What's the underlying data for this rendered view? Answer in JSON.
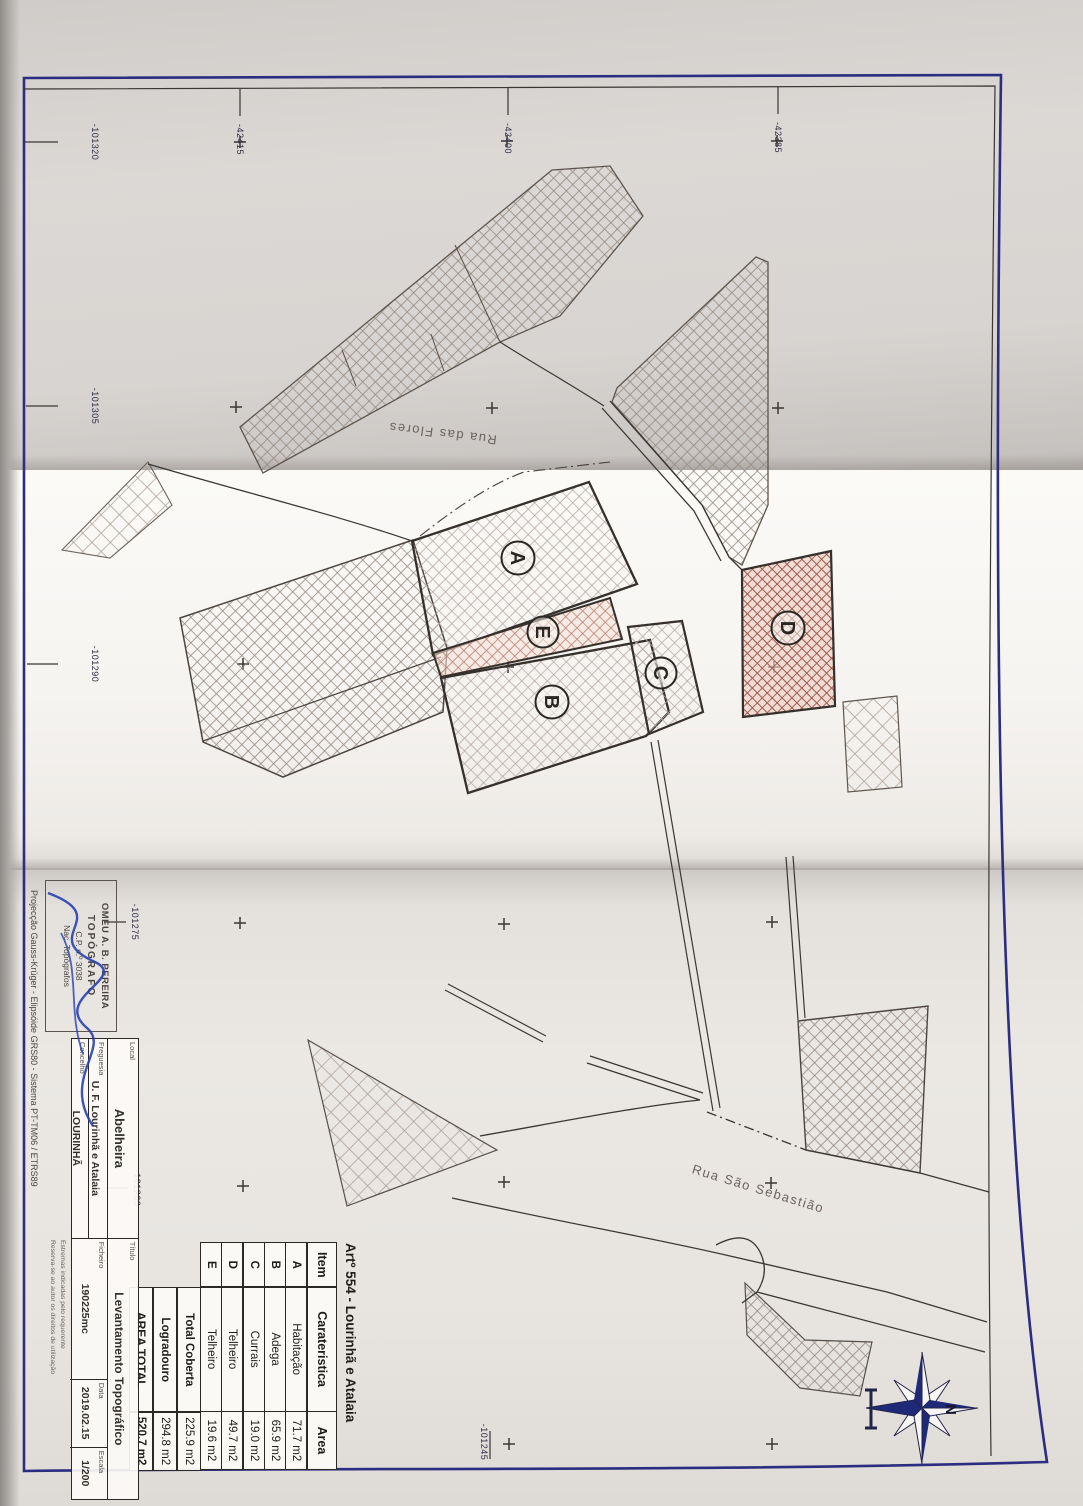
{
  "grid": {
    "top_labels": [
      "-42415",
      "-42400",
      "-42385"
    ],
    "left_labels": [
      "-101320",
      "-101305",
      "-101290",
      "-101275",
      "-101260"
    ],
    "bottom_label": "-101245"
  },
  "streets": {
    "rua_das_flores": "Rua das Flores",
    "rua_sao_sebastiao": "Rua São Sebastião"
  },
  "buildings": {
    "a": "A",
    "b": "B",
    "c": "C",
    "d": "D",
    "e": "E"
  },
  "compass": {
    "north_label": "N"
  },
  "area_table": {
    "title": "Artº 554 - Lourinhã e Atalaia",
    "headers": {
      "item": "Item",
      "caracteristica": "Carateristica",
      "area": "Area"
    },
    "rows": [
      {
        "item": "A",
        "caracteristica": "Habitação",
        "area": "71.7 m2"
      },
      {
        "item": "B",
        "caracteristica": "Adega",
        "area": "65.9 m2"
      },
      {
        "item": "C",
        "caracteristica": "Currais",
        "area": "19.0 m2"
      },
      {
        "item": "D",
        "caracteristica": "Telheiro",
        "area": "49.7 m2"
      },
      {
        "item": "E",
        "caracteristica": "Telheiro",
        "area": "19.6 m2"
      }
    ],
    "totals": [
      {
        "label": "Total Coberta",
        "value": "225.9 m2"
      },
      {
        "label": "Logradouro",
        "value": "294.8 m2"
      },
      {
        "label": "AREA TOTAL",
        "value": "520.7 m2"
      }
    ]
  },
  "title_block": {
    "stamp": {
      "name": "OMEU A. B. PEREIRA",
      "role": "TOPÓGRAFO",
      "number": "C.P. n.º 3038",
      "org": "Nac. Topógrafos"
    },
    "projection": "Projecção Gauss-Krüger - Elipsóide GRS80 - Sistema PT-TM06 / ETRS89",
    "fields": {
      "local_label": "Local",
      "local_value": "Abelheira",
      "freguesia_label": "Freguesia",
      "freguesia_value": "U. F. Lourinhã e Atalaia",
      "concelho_label": "Concelho",
      "concelho_value": "LOURINHÃ",
      "titulo_label": "Título",
      "titulo_value": "Levantamento Topográfico",
      "ficheiro_label": "Ficheiro",
      "ficheiro_value": "190225mc",
      "data_label": "Data",
      "data_value": "2019.02.15",
      "escala_label": "Escala",
      "escala_value": "1/200"
    },
    "notes": [
      "Estremas indicadas pelo requerente",
      "Reserva-se ao autor os direitos de utilização"
    ]
  },
  "colors": {
    "border_navy": "#2c2c80",
    "ink": "#3a3632",
    "signature_blue": "#2740b0",
    "hatch_red": "#9e5546"
  }
}
